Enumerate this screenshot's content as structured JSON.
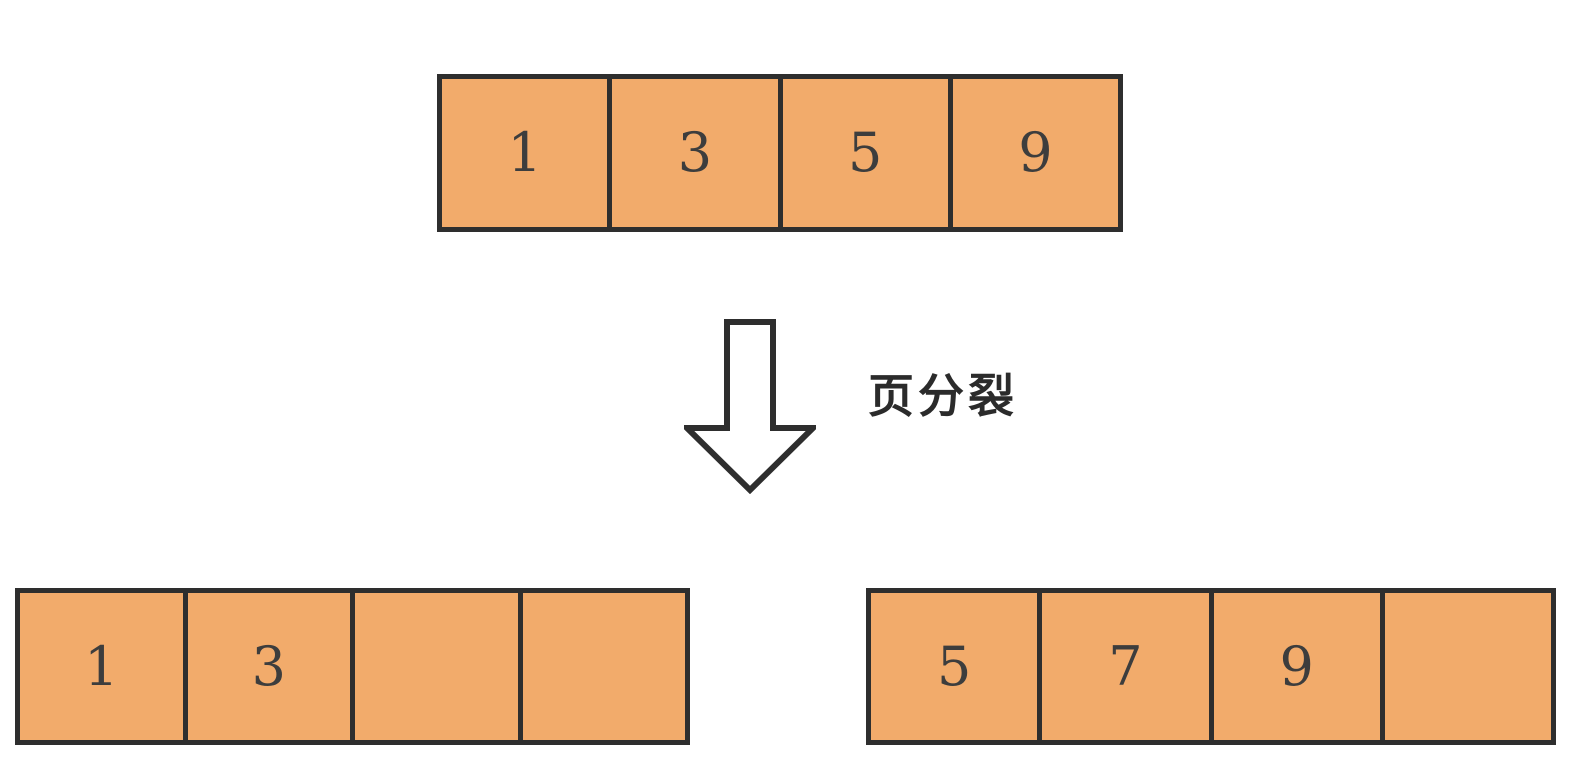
{
  "label": "页分裂",
  "pages": {
    "before": {
      "cells": [
        "1",
        "3",
        "5",
        "9"
      ]
    },
    "after_left": {
      "cells": [
        "1",
        "3",
        "",
        ""
      ]
    },
    "after_right": {
      "cells": [
        "5",
        "7",
        "9",
        ""
      ]
    }
  },
  "colors": {
    "background": "#ffffff",
    "cell_fill": "#f2ab6b",
    "cell_border": "#2e2e2e",
    "digit_text": "#3d3d3d",
    "label_text": "#2b2b2b",
    "arrow_fill": "#ffffff",
    "arrow_outline": "#2e2e2e"
  }
}
